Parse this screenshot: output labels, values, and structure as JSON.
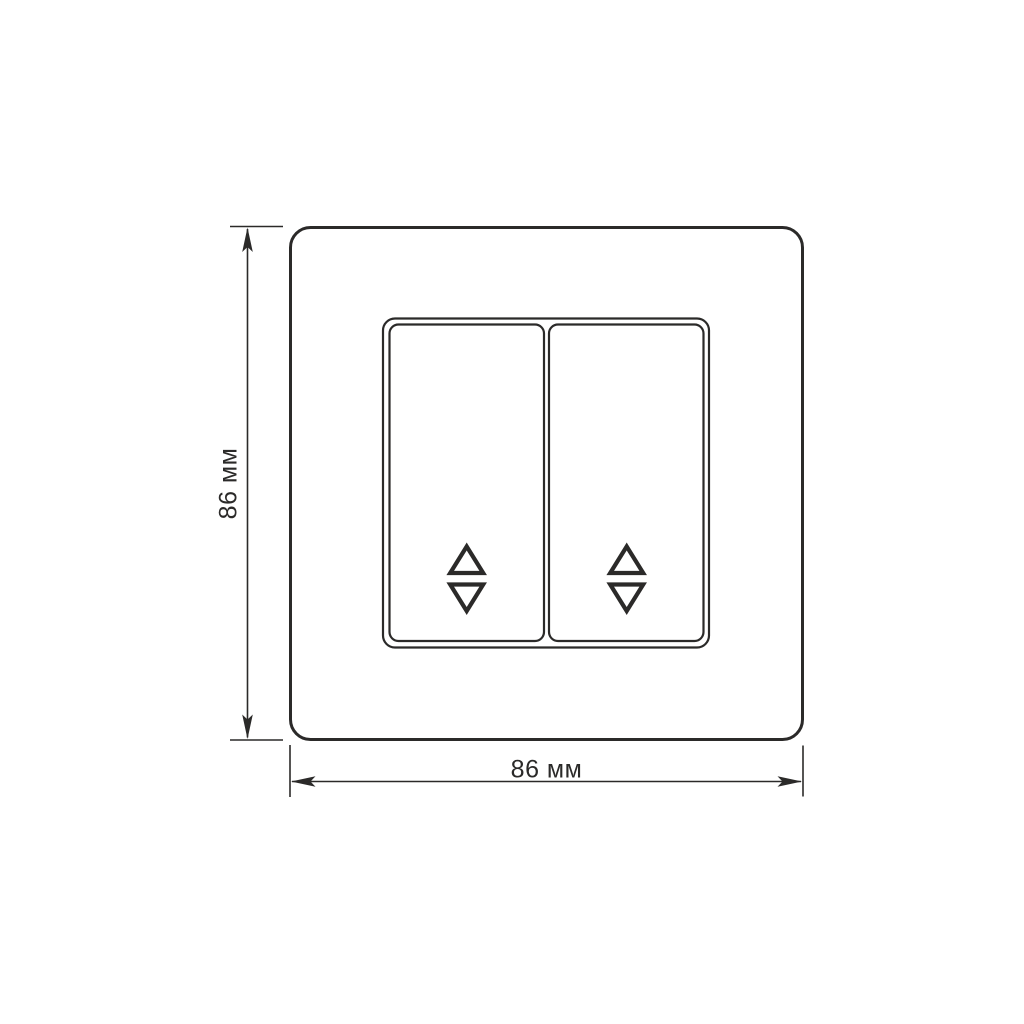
{
  "page": {
    "background": "#ffffff"
  },
  "diagram": {
    "line_color": "#2b2a29",
    "text_color": "#2b2a29",
    "fill_color": "#ffffff",
    "dimensions": {
      "height_label": "86 мм",
      "width_label": "86 мм"
    },
    "icons": {
      "left_rocker_glyph": "up-down-triangle-icon",
      "right_rocker_glyph": "up-down-triangle-icon"
    }
  }
}
